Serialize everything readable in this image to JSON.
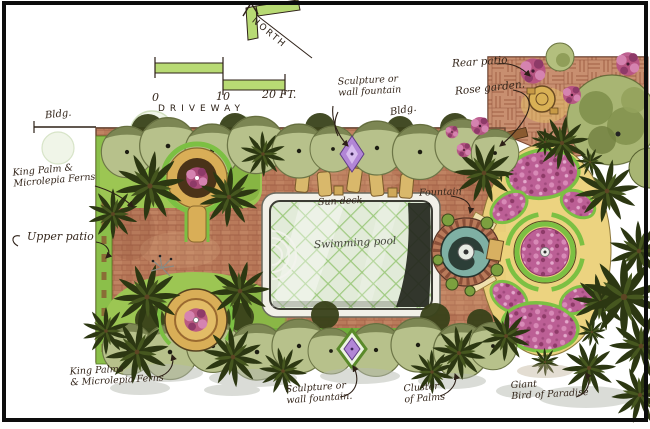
{
  "figure": {
    "kind": "hand-drawn watercolor residential landscape plan",
    "frame_color": "#0d0d0d"
  },
  "compass": {
    "north_label": "NORTH"
  },
  "scale_bar": {
    "tick_0": "0",
    "tick_mid": "10",
    "tick_end": "20 FT."
  },
  "labels": {
    "driveway": "DRIVEWAY",
    "bldg_left": "Bldg.",
    "bldg_top": "Bldg.",
    "sculpture_top": [
      "Sculpture or",
      "wall fountain"
    ],
    "rear_patio": "Rear patio",
    "rose_garden": "Rose garden.",
    "king_palm_top": [
      "King Palm &",
      "Microlepia Ferns"
    ],
    "upper_patio": "Upper patio",
    "sun_deck": "Sun deck",
    "fountain": "Fountain",
    "swimming_pool": "Swimming pool",
    "king_palm_bottom": [
      "King Palms",
      "& Microlepia Ferns"
    ],
    "sculpture_bottom": [
      "Sculpture or",
      "wall fountain."
    ],
    "cluster_palms": [
      "Cluster",
      "of Palms"
    ],
    "giant_bird": [
      "Giant",
      "Bird of Paradise"
    ]
  },
  "palette": {
    "brick": "#b97a5a",
    "brick_line": "#9a5840",
    "basketweave": "#c88f70",
    "pool_water": "#e2ebd9",
    "pool_lattice": "#93c471",
    "pool_shadow": "#23261d",
    "hedge_green": "#b7c18b",
    "edging_green": "#7cc043",
    "palm_dark": "#2c3712",
    "path_tan": "#ecd27c",
    "planter_tan": "#d9ae57",
    "rose_pink": "#bc5f95",
    "sculpture_purple": "#b286d6",
    "scale_green": "#b8da74",
    "ink": "#2d2017"
  }
}
